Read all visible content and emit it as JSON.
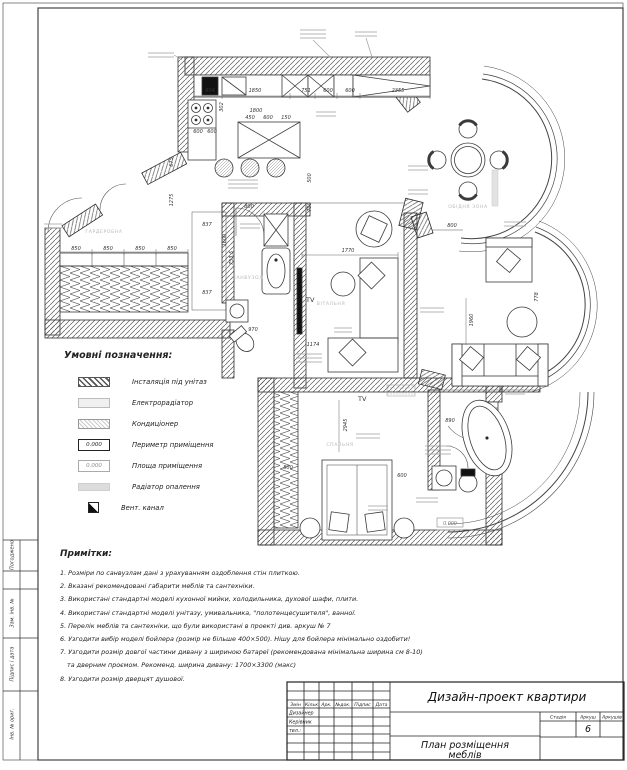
{
  "stamp_left": {
    "items": [
      "Погоджено",
      "Зам. інв. №",
      "Підпис і дата",
      "Інв. № ориг."
    ]
  },
  "legend": {
    "title": "Умовні позначення:",
    "items": [
      {
        "label": "Інсталяція під унітаз"
      },
      {
        "label": "Електрорадіатор"
      },
      {
        "label": "Кондиціонер"
      },
      {
        "label": "Периметр приміщення",
        "value": "0.000"
      },
      {
        "label": "Площа приміщення",
        "value": "0.000"
      },
      {
        "label": "Радіатор опалення"
      },
      {
        "label": "Вент. канал"
      }
    ]
  },
  "notes": {
    "title": "Примітки:",
    "lines": [
      "1. Розміри по санвузлам дані з урахуванням оздоблення стін плиткою.",
      "2. Вказані рекомендовані габарити меблів та сантехніки.",
      "3. Використані стандартні моделі кухонної мийки, холодильника, духової шафи, плити.",
      "4. Використані стандартні моделі унітазу, умивальника, \"полотенцесушителя\", ванної.",
      "5. Перелік меблів та сантехніки, що були використані в проекті див. аркуш № 7",
      "6. Узгодити вибір моделі бойлера (розмір не більше 400×500). Нішу для бойлера мінімально оздобити!",
      "7. Узгодити розмір довгої частини дивану з шириною батареї (рекомендована мінімальна ширина см 8-10)",
      "та дверним проємом. Рекоменд. ширина дивану: 1700×3300 (макс)",
      "8. Узгодити розмір дверцят душової."
    ]
  },
  "titleblock": {
    "project": "Дизайн-проект квартири",
    "doc_line1": "План розміщення",
    "doc_line2": "меблів",
    "cols": [
      "Змін",
      "Кільк",
      "Арк.",
      "№док.",
      "Підпис",
      "Дата"
    ],
    "roles": [
      "Дизайнер",
      "Керівник",
      "тел.:"
    ],
    "stage_cols": [
      "Стадія",
      "Аркуш",
      "Аркушів"
    ],
    "sheet_number": "6"
  },
  "plan": {
    "tv": "TV",
    "room_labels": {
      "dining": "ОБІДНЯ ЗОНА",
      "wardrobe": "ГАРДЕРОБНА",
      "bath": "САНВУЗОЛ",
      "living": "ВІТАЛЬНЯ",
      "bedroom": "СПАЛЬНЯ"
    },
    "dims": {
      "kitchen_top": [
        "604",
        "1850",
        "751",
        "600",
        "600",
        "2355"
      ],
      "kitchen_mid": [
        "1800",
        "450",
        "600",
        "150",
        "302"
      ],
      "kitchen_left": [
        "600",
        "600"
      ],
      "corridor": [
        "675",
        "1275",
        "800",
        "500",
        "700",
        "1600"
      ],
      "niche": [
        "837",
        "753,5",
        "837"
      ],
      "wardrobe_row": [
        "850",
        "850",
        "850",
        "850"
      ],
      "family": [
        "1770",
        "1174",
        "970"
      ],
      "living": [
        "1960",
        "778"
      ],
      "dining": [
        "800"
      ],
      "bedroom": [
        "2945",
        "800",
        "600"
      ],
      "bath_se": [
        "890"
      ],
      "area_value": "0.000"
    }
  }
}
